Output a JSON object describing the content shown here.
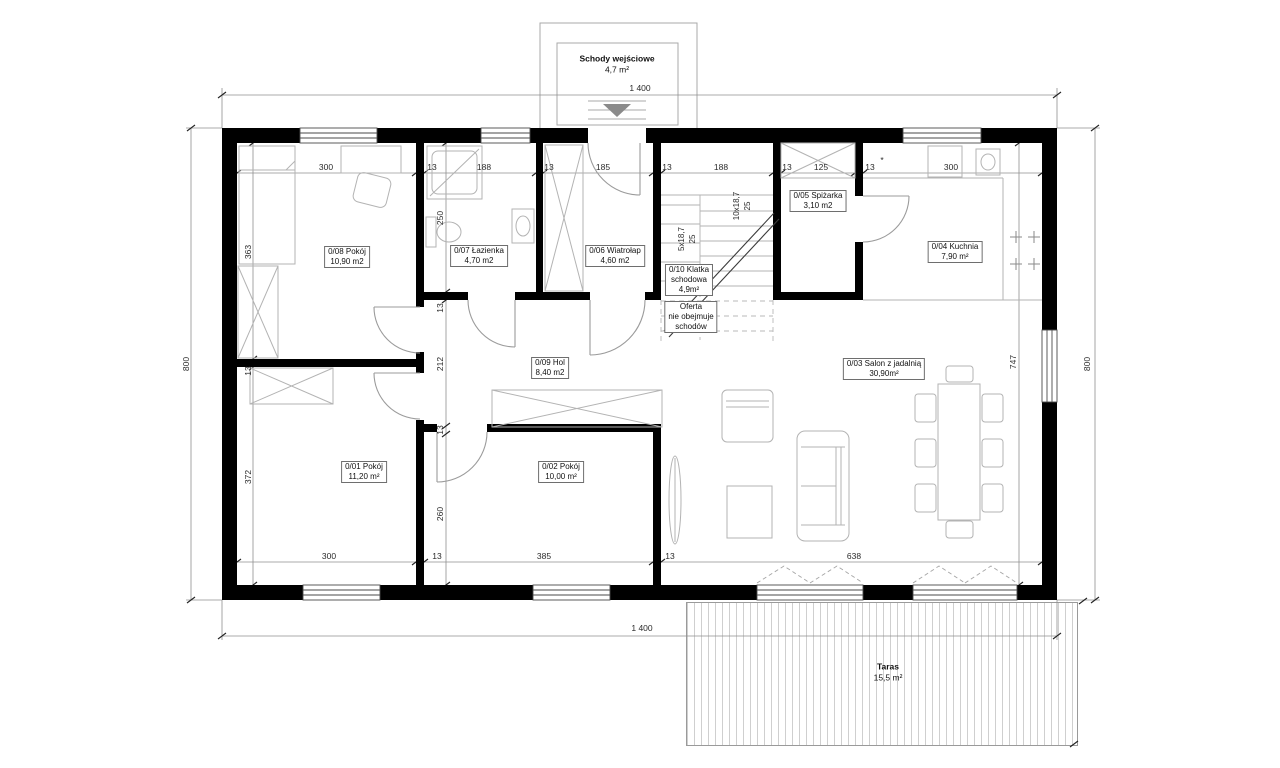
{
  "plan": {
    "entrance_stairs": {
      "name": "Schody wejściowe",
      "area": "4,7 m²"
    },
    "terrace": {
      "name": "Taras",
      "area": "15,5 m²"
    },
    "rooms": [
      {
        "name": "0/08 Pokój",
        "area": "10,90 m2"
      },
      {
        "name": "0/07 Łazienka",
        "area": "4,70 m2"
      },
      {
        "name": "0/06 Wiatrołap",
        "area": "4,60 m2"
      },
      {
        "name": "0/05 Spiżarka",
        "area": "3,10 m2"
      },
      {
        "name": "0/04 Kuchnia",
        "area": "7,90 m²"
      },
      {
        "name": "0/03 Salon z jadalnią",
        "area": "30,90m²"
      },
      {
        "name": "0/09 Hol",
        "area": "8,40 m2"
      },
      {
        "name": "0/01 Pokój",
        "area": "11,20 m²"
      },
      {
        "name": "0/02 Pokój",
        "area": "10,00 m²"
      }
    ],
    "stairwell": {
      "name_l1": "0/10 Klatka",
      "name_l2": "schodowa",
      "area": "4,9m²",
      "note_l1": "Oferta",
      "note_l2": "nie obejmuje",
      "note_l3": "schodów",
      "flight1": "5x18,7",
      "flight1_tread": "25",
      "flight2": "10x18,7",
      "flight2_tread": "25"
    }
  },
  "dims": {
    "overall_width": "1 400",
    "overall_depth": "800",
    "salon_depth": "747",
    "footnote": "*",
    "top": [
      "300",
      "13",
      "188",
      "13",
      "185",
      "13",
      "188",
      "13",
      "125",
      "13",
      "300"
    ],
    "left": [
      "363",
      "13",
      "372"
    ],
    "middle": [
      "250",
      "13",
      "212",
      "13",
      "260"
    ],
    "bottom": [
      "300",
      "13",
      "385",
      "13",
      "638"
    ]
  }
}
